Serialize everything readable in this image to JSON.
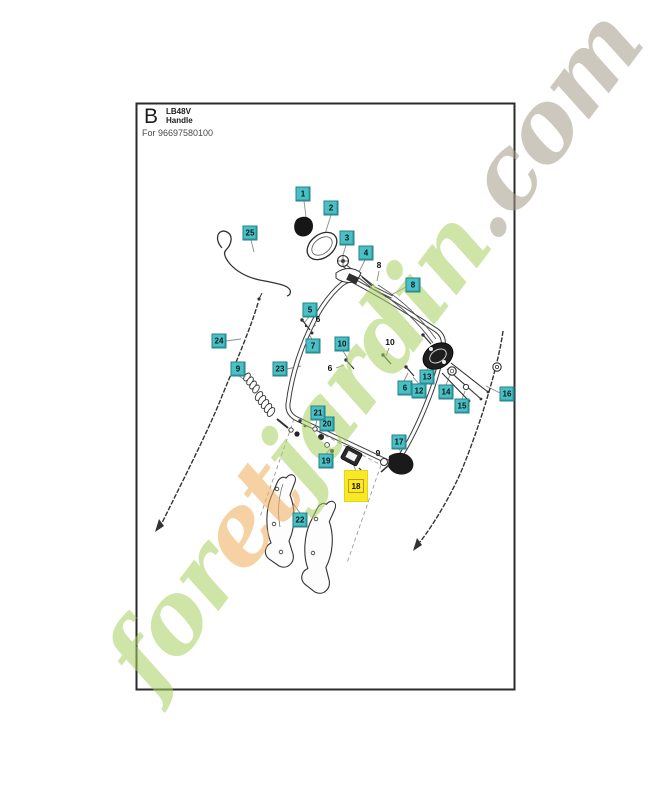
{
  "header": {
    "letter": "B",
    "model": "LB48V",
    "section": "Handle",
    "for_text": "For 96697580100"
  },
  "watermark": {
    "segments": [
      {
        "text": "for",
        "color": "#a9cf60"
      },
      {
        "text": "et",
        "color": "#f0ac58"
      },
      {
        "text": "jardin",
        "color": "#a9cf60"
      },
      {
        "text": ".com",
        "color": "#a59c88"
      }
    ]
  },
  "diagram": {
    "title": "Exploded parts view of mower handle assembly",
    "highlighted_part": "18",
    "labels": [
      {
        "text": "1",
        "x": 303,
        "y": 194,
        "style": "box"
      },
      {
        "text": "2",
        "x": 331,
        "y": 208,
        "style": "box"
      },
      {
        "text": "3",
        "x": 347,
        "y": 238,
        "style": "box"
      },
      {
        "text": "4",
        "x": 366,
        "y": 253,
        "style": "box"
      },
      {
        "text": "25",
        "x": 250,
        "y": 233,
        "style": "box"
      },
      {
        "text": "24",
        "x": 219,
        "y": 341,
        "style": "box"
      },
      {
        "text": "23",
        "x": 280,
        "y": 369,
        "style": "box"
      },
      {
        "text": "9",
        "x": 238,
        "y": 369,
        "style": "box"
      },
      {
        "text": "5",
        "x": 310,
        "y": 310,
        "style": "box"
      },
      {
        "text": "6",
        "x": 318,
        "y": 319,
        "style": "plain"
      },
      {
        "text": "7",
        "x": 313,
        "y": 346,
        "style": "box"
      },
      {
        "text": "8",
        "x": 379,
        "y": 265,
        "style": "plain"
      },
      {
        "text": "8",
        "x": 413,
        "y": 285,
        "style": "box"
      },
      {
        "text": "10",
        "x": 342,
        "y": 344,
        "style": "box"
      },
      {
        "text": "10",
        "x": 390,
        "y": 342,
        "style": "plain"
      },
      {
        "text": "6",
        "x": 330,
        "y": 368,
        "style": "plain"
      },
      {
        "text": "6",
        "x": 405,
        "y": 388,
        "style": "box"
      },
      {
        "text": "12",
        "x": 419,
        "y": 391,
        "style": "box"
      },
      {
        "text": "13",
        "x": 427,
        "y": 377,
        "style": "box"
      },
      {
        "text": "14",
        "x": 446,
        "y": 392,
        "style": "box"
      },
      {
        "text": "15",
        "x": 462,
        "y": 406,
        "style": "box"
      },
      {
        "text": "16",
        "x": 507,
        "y": 394,
        "style": "box"
      },
      {
        "text": "17",
        "x": 399,
        "y": 442,
        "style": "box"
      },
      {
        "text": "9",
        "x": 378,
        "y": 453,
        "style": "plain"
      },
      {
        "text": "18",
        "x": 356,
        "y": 486,
        "style": "highlight"
      },
      {
        "text": "19",
        "x": 326,
        "y": 461,
        "style": "box"
      },
      {
        "text": "20",
        "x": 327,
        "y": 424,
        "style": "box"
      },
      {
        "text": "21",
        "x": 318,
        "y": 413,
        "style": "box"
      },
      {
        "text": "22",
        "x": 300,
        "y": 520,
        "style": "box"
      }
    ]
  },
  "colors": {
    "label_bg": "#4bbfc4",
    "label_border": "#23838b",
    "highlight_bg": "#f8e926",
    "highlight_inner_border": "#c9951c",
    "frame": "#2b2b2b",
    "line": "#3d3d3d"
  }
}
